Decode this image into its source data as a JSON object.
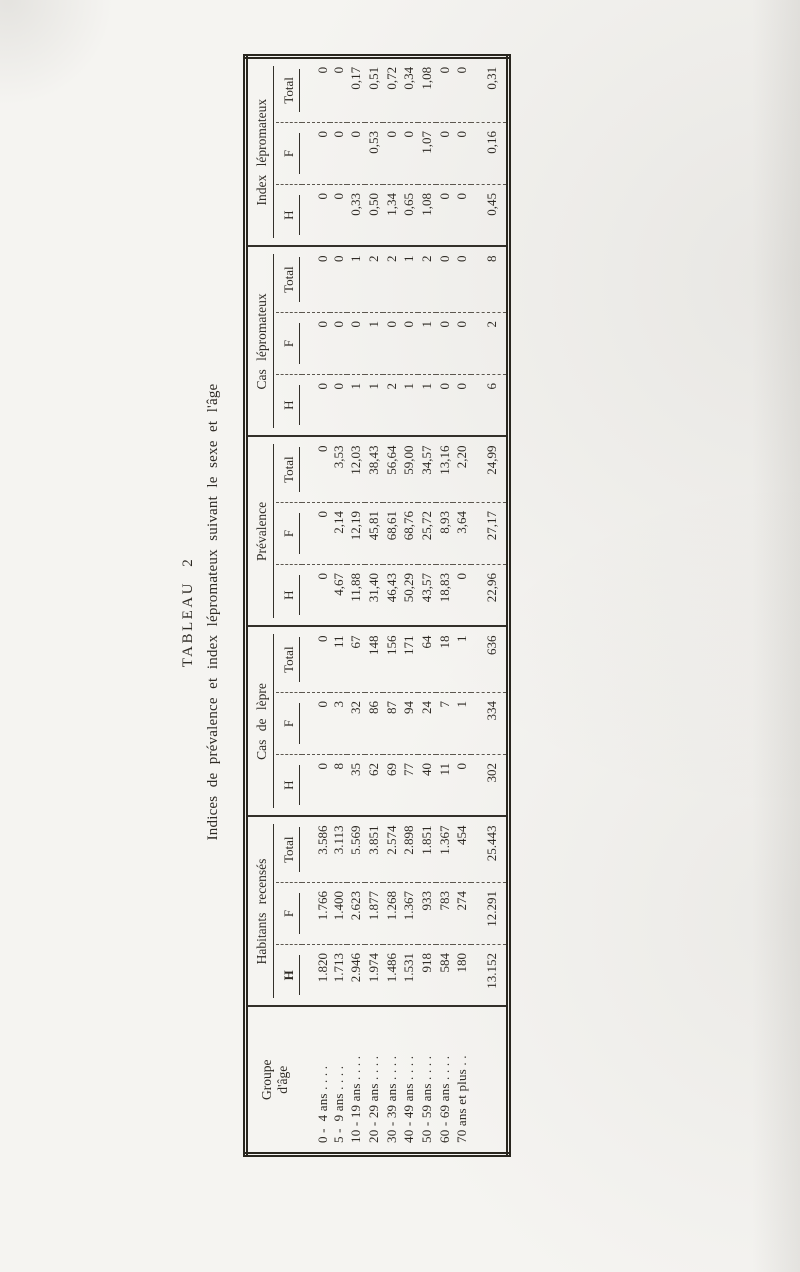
{
  "title": "TABLEAU 2",
  "subtitle": "Indices de prévalence et index lépromateux suivant le sexe et l'âge",
  "table": {
    "row_header_lines": [
      "Groupe",
      "d'âge"
    ],
    "groups": [
      {
        "label": "Habitants recensés",
        "columns": [
          "H",
          "F",
          "Total"
        ]
      },
      {
        "label": "Cas de lèpre",
        "columns": [
          "H",
          "F",
          "Total"
        ]
      },
      {
        "label": "Prévalence",
        "columns": [
          "H",
          "F",
          "Total"
        ]
      },
      {
        "label": "Cas lépromateux",
        "columns": [
          "H",
          "F",
          "Total"
        ]
      },
      {
        "label": "Index lépromateux",
        "columns": [
          "H",
          "F",
          "Total"
        ]
      }
    ],
    "rows": [
      {
        "age": "0 -  4 ans . . . .",
        "values": [
          "1.820",
          "1.766",
          "3.586",
          "0",
          "0",
          "0",
          "0",
          "0",
          "0",
          "0",
          "0",
          "0",
          "0",
          "0",
          "0"
        ]
      },
      {
        "age": "5 -  9 ans . . . .",
        "values": [
          "1.713",
          "1.400",
          "3.113",
          "8",
          "3",
          "11",
          "4,67",
          "2,14",
          "3,53",
          "0",
          "0",
          "0",
          "0",
          "0",
          "0"
        ]
      },
      {
        "age": "10 - 19 ans . . . .",
        "values": [
          "2.946",
          "2.623",
          "5.569",
          "35",
          "32",
          "67",
          "11,88",
          "12,19",
          "12,03",
          "1",
          "0",
          "1",
          "0,33",
          "0",
          "0,17"
        ]
      },
      {
        "age": "20 - 29 ans . . . .",
        "values": [
          "1.974",
          "1.877",
          "3.851",
          "62",
          "86",
          "148",
          "31,40",
          "45,81",
          "38,43",
          "1",
          "1",
          "2",
          "0,50",
          "0,53",
          "0,51"
        ]
      },
      {
        "age": "30 - 39 ans . . . .",
        "values": [
          "1.486",
          "1.268",
          "2.574",
          "69",
          "87",
          "156",
          "46,43",
          "68,61",
          "56,64",
          "2",
          "0",
          "2",
          "1,34",
          "0",
          "0,72"
        ]
      },
      {
        "age": "40 - 49 ans . . . .",
        "values": [
          "1.531",
          "1.367",
          "2.898",
          "77",
          "94",
          "171",
          "50,29",
          "68,76",
          "59,00",
          "1",
          "0",
          "1",
          "0,65",
          "0",
          "0,34"
        ]
      },
      {
        "age": "50 - 59 ans . . . .",
        "values": [
          "918",
          "933",
          "1.851",
          "40",
          "24",
          "64",
          "43,57",
          "25,72",
          "34,57",
          "1",
          "1",
          "2",
          "1,08",
          "1,07",
          "1,08"
        ]
      },
      {
        "age": "60 - 69 ans . . . .",
        "values": [
          "584",
          "783",
          "1.367",
          "11",
          "7",
          "18",
          "18,83",
          "8,93",
          "13,16",
          "0",
          "0",
          "0",
          "0",
          "0",
          "0"
        ]
      },
      {
        "age": "70 ans et plus . .",
        "values": [
          "180",
          "274",
          "454",
          "0",
          "1",
          "1",
          "0",
          "3,64",
          "2,20",
          "0",
          "0",
          "0",
          "0",
          "0",
          "0"
        ]
      }
    ],
    "totals": {
      "age": "",
      "values": [
        "13.152",
        "12.291",
        "25.443",
        "302",
        "334",
        "636",
        "22,96",
        "27,17",
        "24,99",
        "6",
        "2",
        "8",
        "0,45",
        "0,16",
        "0,31"
      ]
    }
  }
}
